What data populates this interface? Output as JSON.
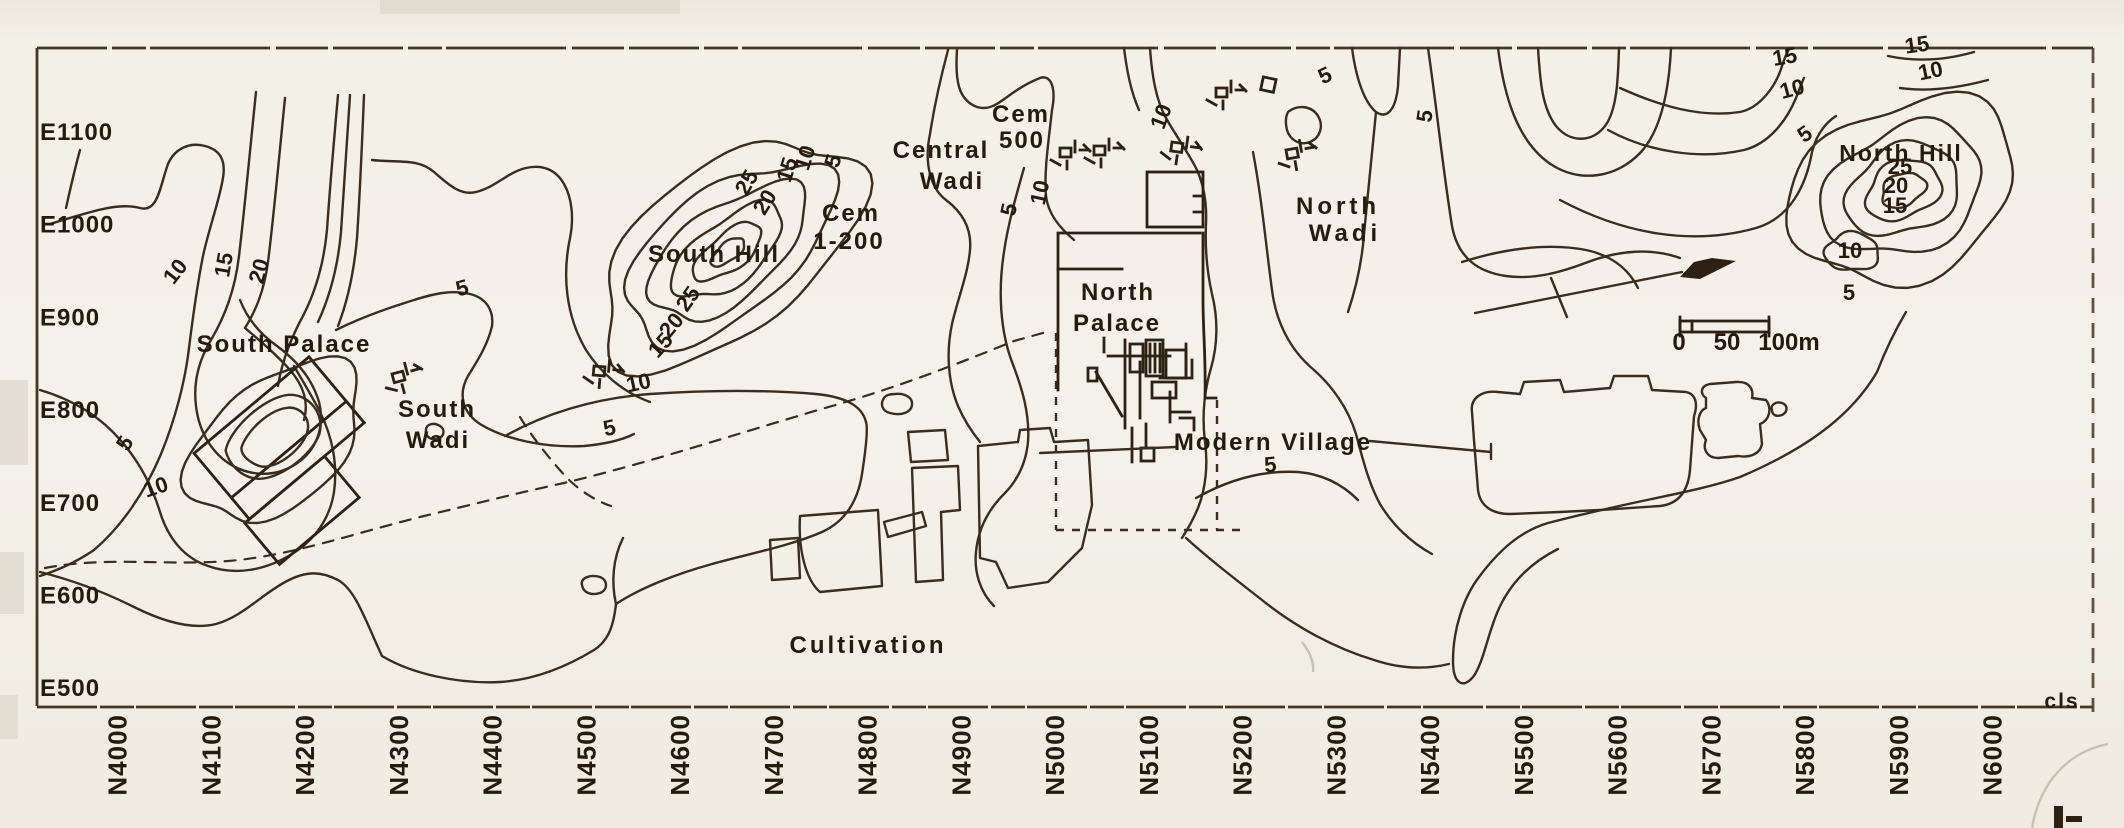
{
  "map": {
    "eastings": [
      "E1100",
      "E1000",
      "E900",
      "E800",
      "E700",
      "E600",
      "E500"
    ],
    "northings": [
      "N4000",
      "N4100",
      "N4200",
      "N4300",
      "N4400",
      "N4500",
      "N4600",
      "N4700",
      "N4800",
      "N4900",
      "N5000",
      "N5100",
      "N5200",
      "N5300",
      "N5400",
      "N5500",
      "N5600",
      "N5700",
      "N5800",
      "N5900",
      "N6000"
    ],
    "region_labels": [
      {
        "name": "south-palace",
        "text": "South Palace",
        "x": 284,
        "y": 352
      },
      {
        "name": "south-wadi-line1",
        "text": "South",
        "x": 437,
        "y": 417
      },
      {
        "name": "south-wadi-line2",
        "text": "Wadi",
        "x": 438,
        "y": 448
      },
      {
        "name": "south-hill",
        "text": "South Hill",
        "x": 714,
        "y": 262
      },
      {
        "name": "cem-1-200-line1",
        "text": "Cem",
        "x": 851,
        "y": 221
      },
      {
        "name": "cem-1-200-line2",
        "text": "1-200",
        "x": 849,
        "y": 249
      },
      {
        "name": "central-wadi-line1",
        "text": "Central",
        "x": 941,
        "y": 158
      },
      {
        "name": "central-wadi-line2",
        "text": "Wadi",
        "x": 952,
        "y": 189
      },
      {
        "name": "cem-500-line1",
        "text": "Cem",
        "x": 1021,
        "y": 122
      },
      {
        "name": "cem-500-line2",
        "text": "500",
        "x": 1022,
        "y": 148
      },
      {
        "name": "north-palace-line1",
        "text": "North",
        "x": 1118,
        "y": 300
      },
      {
        "name": "north-palace-line2",
        "text": "Palace",
        "x": 1117,
        "y": 331
      },
      {
        "name": "north-wadi-line1",
        "text": "North",
        "x": 1338,
        "y": 214,
        "ls": 4
      },
      {
        "name": "north-wadi-line2",
        "text": "Wadi",
        "x": 1345,
        "y": 241,
        "ls": 4
      },
      {
        "name": "modern-village",
        "text": "Modern Village",
        "x": 1273,
        "y": 450
      },
      {
        "name": "cultivation",
        "text": "Cultivation",
        "x": 868,
        "y": 653,
        "ls": 3
      },
      {
        "name": "north-hill",
        "text": "North Hill",
        "x": 1901,
        "y": 161,
        "fs": 23
      },
      {
        "name": "corner-note-cls",
        "text": "cls",
        "x": 2062,
        "y": 708,
        "fs": 21
      },
      {
        "name": "scale-0",
        "text": "0",
        "x": 1679,
        "y": 350,
        "fs": 24,
        "ls": 0
      },
      {
        "name": "scale-50",
        "text": "50",
        "x": 1727,
        "y": 350,
        "fs": 24,
        "ls": 0
      },
      {
        "name": "scale-100m",
        "text": "100m",
        "x": 1789,
        "y": 350,
        "fs": 24,
        "ls": 0
      }
    ],
    "contour_labels": [
      {
        "v": "10",
        "x": 181,
        "y": 276,
        "r": -52
      },
      {
        "v": "15",
        "x": 231,
        "y": 266,
        "r": -80
      },
      {
        "v": "20",
        "x": 266,
        "y": 273,
        "r": -74
      },
      {
        "v": "5",
        "x": 464,
        "y": 295,
        "r": -15
      },
      {
        "v": "5",
        "x": 131,
        "y": 447,
        "r": -58
      },
      {
        "v": "10",
        "x": 158,
        "y": 494,
        "r": -18
      },
      {
        "v": "25",
        "x": 753,
        "y": 186,
        "r": -60
      },
      {
        "v": "20",
        "x": 771,
        "y": 206,
        "r": -58
      },
      {
        "v": "15",
        "x": 794,
        "y": 172,
        "r": -72
      },
      {
        "v": "10",
        "x": 812,
        "y": 160,
        "r": -72
      },
      {
        "v": "5",
        "x": 840,
        "y": 163,
        "r": -72
      },
      {
        "v": "25",
        "x": 694,
        "y": 303,
        "r": -55
      },
      {
        "v": "20",
        "x": 677,
        "y": 330,
        "r": -50
      },
      {
        "v": "15",
        "x": 666,
        "y": 350,
        "r": -48
      },
      {
        "v": "10",
        "x": 640,
        "y": 390,
        "r": -12
      },
      {
        "v": "5",
        "x": 611,
        "y": 435,
        "r": -12
      },
      {
        "v": "10",
        "x": 1047,
        "y": 194,
        "r": -78
      },
      {
        "v": "5",
        "x": 1016,
        "y": 211,
        "r": -78
      },
      {
        "v": "10",
        "x": 1168,
        "y": 119,
        "r": -70
      },
      {
        "v": "5",
        "x": 1328,
        "y": 82,
        "r": -25
      },
      {
        "v": "5",
        "x": 1432,
        "y": 117,
        "r": -82
      },
      {
        "v": "5",
        "x": 1271,
        "y": 472,
        "r": -5
      },
      {
        "v": "15",
        "x": 1786,
        "y": 64,
        "r": -10
      },
      {
        "v": "10",
        "x": 1794,
        "y": 96,
        "r": -15
      },
      {
        "v": "5",
        "x": 1809,
        "y": 140,
        "r": -35
      },
      {
        "v": "15",
        "x": 1918,
        "y": 52,
        "r": -8
      },
      {
        "v": "10",
        "x": 1932,
        "y": 78,
        "r": -12
      },
      {
        "v": "25",
        "x": 1900,
        "y": 174,
        "r": 0
      },
      {
        "v": "20",
        "x": 1896,
        "y": 193,
        "r": 0
      },
      {
        "v": "15",
        "x": 1895,
        "y": 213,
        "r": 0
      },
      {
        "v": "10",
        "x": 1850,
        "y": 258,
        "r": 0
      },
      {
        "v": "5",
        "x": 1849,
        "y": 300,
        "r": 0
      }
    ]
  }
}
